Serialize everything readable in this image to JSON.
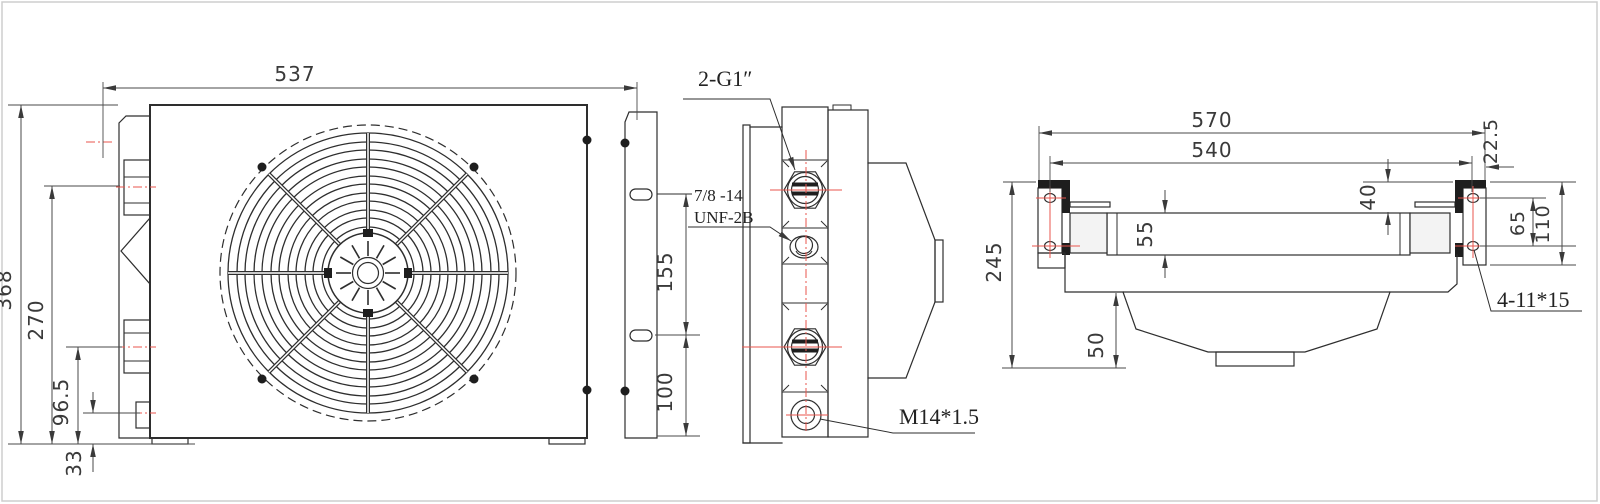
{
  "colors": {
    "line": "#2e2e2e",
    "center_mark": "#e8564e",
    "frame": "#cccccc",
    "text": "#3a3a3a"
  },
  "front_view": {
    "dim_width": "537",
    "dim_height": "368",
    "dim_bracket_span": "270",
    "dim_bracket_lower": "96.5",
    "dim_foot": "33"
  },
  "side_view": {
    "label_main_ports": "2-G1″",
    "label_aux_port_line1": "7/8 -14",
    "label_aux_port_line2": "UNF-2B",
    "label_drain_port": "M14*1.5",
    "dim_port_spacing": "155",
    "dim_port_bottom": "100"
  },
  "top_view": {
    "dim_overall": "570",
    "dim_hole_span": "540",
    "dim_hole_offset": "22.5",
    "dim_depth": "245",
    "dim_bracket_above": "40",
    "dim_core_thickness": "55",
    "dim_hole_pitch": "65",
    "dim_bracket_height": "110",
    "dim_shroud_depth": "50",
    "label_mount_slots": "4-11*15"
  }
}
